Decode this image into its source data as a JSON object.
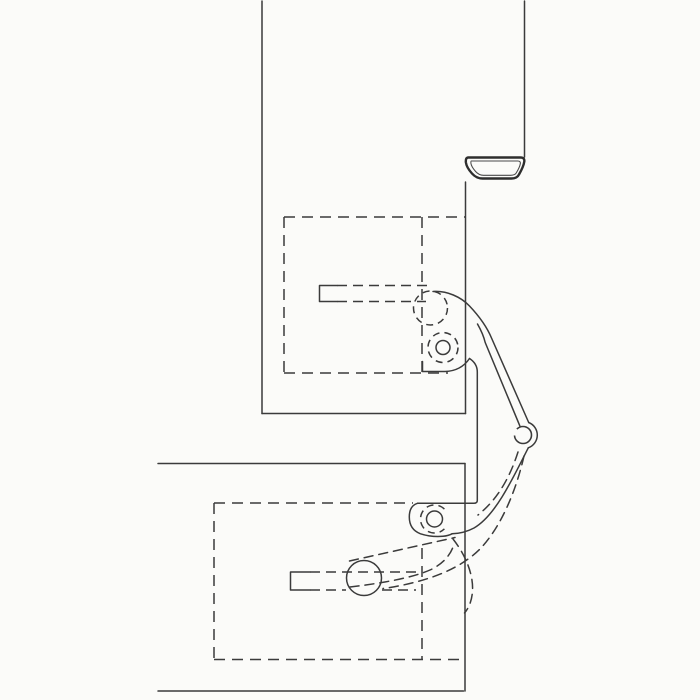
{
  "drawing": {
    "kind": "technical-line-drawing",
    "subject": "concealed-door-hinge-cross-section",
    "canvas": {
      "width": 700,
      "height": 700
    },
    "colors": {
      "background": "#fbfbf9",
      "line": "#3b3b3b",
      "seal_line": "#2e2e2e"
    },
    "paths": {
      "frame_left_edge": {
        "d": "M262,1 L262,413.5"
      },
      "frame_bottom_edge": {
        "d": "M262,413.5 L465.5,413.5"
      },
      "frame_inner_face": {
        "d": "M465.5,413.5 L465.5,182"
      },
      "frame_outer_edge": {
        "d": "M524.5,1 L524.5,157"
      },
      "seal_outer_contour": {
        "d": "M468,157.5 L520.5,157.5 Q524.8,157.5 524.3,161.5 Q523.6,166.5 519,174.5 Q517,178.5 511.5,178.5 L482.5,178.5 Q476.5,178.5 472,173.5 Q466.6,167.5 465.9,162.5 Q465.4,157.8 468,157.5 Z"
      },
      "seal_inner_contour": {
        "d": "M471.2,161 L517.8,161 Q520.8,161 520.3,163.8 Q519.7,167.3 516.2,173 Q514.8,175.3 510.5,175.3 L483.5,175.3 Q479,175.3 475.6,171.5 Q471.5,166.8 471,163.7 Q470.7,161.2 471.2,161 Z"
      },
      "door_top_edge": {
        "d": "M158,463.5 L465,463.5"
      },
      "door_right_edge": {
        "d": "M465,463.5 L465,691"
      },
      "door_bottom_edge": {
        "d": "M158,691 L463.5,691"
      },
      "upper_mortise_top": {
        "d": "M284,217 L465,217"
      },
      "upper_mortise_left": {
        "d": "M284,217 L284,373"
      },
      "upper_mortise_bottom": {
        "d": "M284,373 L448,373"
      },
      "upper_mortise_inner": {
        "d": "M422,217 L422,373"
      },
      "upper_slot_bracket": {
        "d": "M337,285.5 L319.5,285.5 L319.5,301.5 L337,301.5"
      },
      "upper_slot_top_line": {
        "d": "M337,285.5 L429,285.5"
      },
      "upper_slot_bottom_line": {
        "d": "M337,301.5 L426,301.5"
      },
      "upper_roller_circle": {
        "d": "M447.5,308 A17,17 0 1 1 413.5,308 A17,17 0 1 1 447.5,308"
      },
      "cam_circle_inner": {
        "d": "M450,347.5 A7,7 0 1 1 436,347.5 A7,7 0 1 1 450,347.5"
      },
      "cam_circle_ring": {
        "d": "M458,347.5 A15,15 0 1 1 428,347.5 A15,15 0 1 1 458,347.5"
      },
      "hinge_arm_outer": {
        "d": "M433,291.5 C447,290.5 461,297 469.5,306 C478.5,315.5 486.5,326 491.5,338 L528.7,422.5"
      },
      "hinge_arm_inner": {
        "d": "M477.5,324 C481.5,331 484,337.5 485.2,342.5 L519.8,425.8"
      },
      "pivot_wrap": {
        "d": "M528.7,422.5 A13.5,13.5 0 0 1 528.3,447.8"
      },
      "pivot_inner_circle": {
        "d": "M531.5,435 A8.5,8.5 0 1 1 514.5,435 A8.5,8.5 0 1 1 531.5,435"
      },
      "arm_lower_outer": {
        "d": "M528.3,447.8 C522,460 512,481 502,497 C493,511.5 483.5,522.5 474,528 C467.5,531.5 459.5,533.5 452,533.8"
      },
      "cup_bottom_edge": {
        "d": "M422.5,361.5 L422.5,371.5 L445,371.5 Q461,371 469.5,358.5"
      },
      "center_part_edge": {
        "d": "M469.5,358.5 Q477.3,363.5 477.3,372 L477.3,500.5 Q477.3,503.3 473.8,503.3 L465.3,503.3"
      },
      "knuckle_top_edge": {
        "d": "M417.5,503.3 L465,503.3"
      },
      "knuckle_cup": {
        "d": "M417.5,503.3 Q409.3,505.8 409.3,517 Q409.3,529.5 420.5,533.8 Q431.5,537.3 443,536.3 Q448.5,535.7 452,533.8"
      },
      "knuckle_circle_inner": {
        "d": "M442.5,519 A8,8 0 1 1 426.5,519 A8,8 0 1 1 442.5,519"
      },
      "knuckle_circle_ring": {
        "d": "M444.4,509.1 A14,14 0 1 0 444.4,528.9"
      },
      "lower_mortise_top": {
        "d": "M214,503 L413,503"
      },
      "lower_mortise_left": {
        "d": "M214,503 L214,659.5"
      },
      "lower_mortise_bottom": {
        "d": "M214,659.5 L463,659.5"
      },
      "lower_mortise_inner": {
        "d": "M422,548 L422,659.5"
      },
      "lower_slot_bracket": {
        "d": "M310,572 L290.5,572 L290.5,590 L310,590"
      },
      "lower_slot_top_line": {
        "d": "M310,572 L418,572"
      },
      "lower_slot_bottom_left": {
        "d": "M310,590 L346,590"
      },
      "lower_slot_bottom_right": {
        "d": "M382,590 L416,590"
      },
      "lower_roller_circle": {
        "d": "M381.5,578 A17.5,17.5 0 1 1 346.5,578 A17.5,17.5 0 1 1 381.5,578"
      },
      "ghost_arm_inner": {
        "d": "M518,452 C510,477 498,499 478,515"
      },
      "ghost_swing_outer": {
        "d": "M524,456 C516,491 501,527 480,549 C466.5,562.5 448,572 429.5,578 C414,583 398,586.5 383,588.5"
      },
      "ghost_link_top": {
        "d": "M349.5,561 L455,537.5"
      },
      "ghost_link_bottom": {
        "d": "M350,587 C384,583 413,577.5 430,570 C442,564.5 450.5,555.5 453.5,545.5"
      },
      "ghost_leaf_arc": {
        "d": "M453,539 C466,555.5 473.5,575 472.5,591 C472,600 469,608 464.5,613"
      }
    }
  }
}
